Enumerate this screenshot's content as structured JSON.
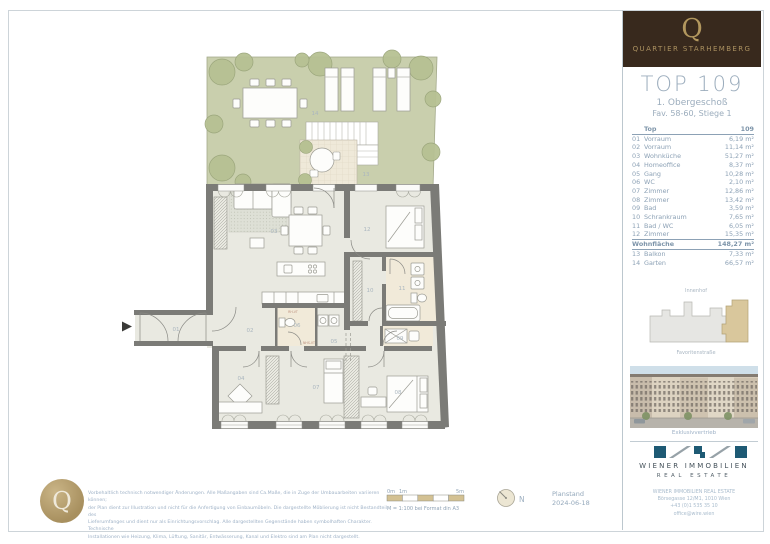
{
  "brand": {
    "logo_letter": "Q",
    "name": "QUARTIER STARHEMBERG"
  },
  "header": {
    "title": "TOP 109",
    "subtitle1": "1. Obergeschoß",
    "subtitle2": "Fav. 58-60, Stiege 1"
  },
  "table": {
    "header": {
      "label": "Top",
      "value": "109"
    },
    "rows": [
      {
        "no": "01",
        "name": "Vorraum",
        "area": "6,19 m²"
      },
      {
        "no": "02",
        "name": "Vorraum",
        "area": "11,14 m²"
      },
      {
        "no": "03",
        "name": "Wohnküche",
        "area": "51,27 m²"
      },
      {
        "no": "04",
        "name": "Homeoffice",
        "area": "8,37 m²"
      },
      {
        "no": "05",
        "name": "Gang",
        "area": "10,28 m²"
      },
      {
        "no": "06",
        "name": "WC",
        "area": "2,10 m²"
      },
      {
        "no": "07",
        "name": "Zimmer",
        "area": "12,86 m²"
      },
      {
        "no": "08",
        "name": "Zimmer",
        "area": "13,42 m²"
      },
      {
        "no": "09",
        "name": "Bad",
        "area": "3,59 m²"
      },
      {
        "no": "10",
        "name": "Schrankraum",
        "area": "7,65 m²"
      },
      {
        "no": "11",
        "name": "Bad / WC",
        "area": "6,05 m²"
      },
      {
        "no": "12",
        "name": "Zimmer",
        "area": "15,35 m²"
      }
    ],
    "total": {
      "label": "Wohnfläche",
      "value": "148,27 m²"
    },
    "extra": [
      {
        "no": "13",
        "name": "Balkon",
        "area": "7,33 m²"
      },
      {
        "no": "14",
        "name": "Garten",
        "area": "66,57 m²"
      }
    ]
  },
  "keyplan": {
    "top_label": "Innenhof",
    "bottom_label": "Favoritenstraße"
  },
  "photo_caption": "Exklusivvertrieb",
  "agency": {
    "name": "WIENER IMMOBILIEN",
    "subname": "REAL ESTATE",
    "contact": [
      "WIENER IMMOBILIEN REAL ESTATE",
      "Börsegasse 12/M1, 1010 Wien",
      "+43 (0)1 535 35 10",
      "office@wire.wien"
    ]
  },
  "plan": {
    "labels": [
      "01",
      "02",
      "03",
      "04",
      "05",
      "06",
      "07",
      "08",
      "09",
      "10",
      "11",
      "12",
      "13",
      "14"
    ],
    "annotations": {
      "rh": "RH-VT",
      "nhs": "NHS-VT"
    }
  },
  "footer": {
    "disclaimer": [
      "Vorbehaltlich technisch notwendiger Änderungen. Alle Maßangaben sind Ca.Maße, die in Zuge der Umbauarbeiten variieren können;",
      "der Plan dient zur Illustration und nicht für die Anfertigung von Einbaumöbeln. Die dargestellte Möblierung ist nicht Bestandteil des",
      "Lieferumfanges und dient nur als Einrichtungsvorschlag. Alle dargestellten Gegenstände haben symbolhaften Charakter. Technische",
      "Installationen wie Heizung, Klima, Lüftung, Sanitär, Entwässerung, Kanal und Elektro sind am Plan nicht dargestellt."
    ],
    "scale": {
      "t0": "0m",
      "t1": "1m",
      "t5": "5m",
      "caption": "M = 1:100 bei Format din A3"
    },
    "north_label": "N",
    "planstand_label": "Planstand",
    "planstand_date": "2024-06-18"
  },
  "colors": {
    "header_brown": "#38291d",
    "accent_gold": "#ab9160",
    "text_blue": "#8ca1b5",
    "garden_green": "#c9cfad",
    "wall_gray": "#7b7b77",
    "bath_cream": "#f1ead9",
    "highlight_tan": "#d9c79c",
    "logo_blue": "#1e5a74"
  }
}
